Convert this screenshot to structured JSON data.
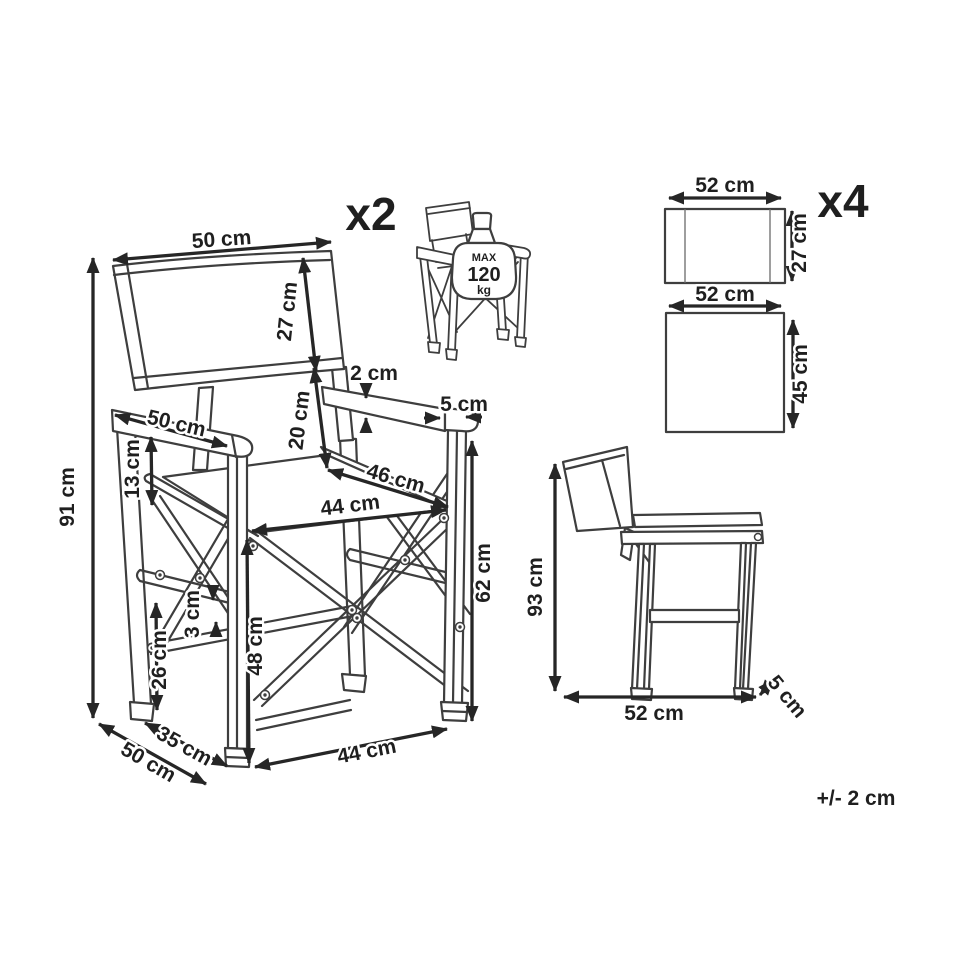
{
  "front_view": {
    "quantity": "x2",
    "back_width": "50 cm",
    "back_height": "27 cm",
    "armrest_thickness": "2 cm",
    "armrest_end_width": "5 cm",
    "back_to_seat_gap": "20 cm",
    "armrest_length": "50 cm",
    "seat_width": "46 cm",
    "seat_depth": "44 cm",
    "armrest_above_seat": "13 cm",
    "overall_height": "91 cm",
    "armrest_height": "62 cm",
    "seat_height": "48 cm",
    "rail_gap": "3 cm",
    "stretcher_height": "26 cm",
    "leg_spread_depth": "35 cm",
    "overall_depth": "50 cm",
    "front_leg_span": "44 cm"
  },
  "max_load_badge": {
    "line1": "MAX",
    "line2": "120",
    "line3": "kg"
  },
  "seat_covers": {
    "quantity": "x4",
    "backrest_cover": {
      "width": "52 cm",
      "height": "27 cm"
    },
    "seat_cover": {
      "width": "52 cm",
      "height": "45 cm"
    }
  },
  "side_view": {
    "height": "93 cm",
    "width": "52 cm",
    "thickness": "5 cm"
  },
  "tolerance": "+/- 2 cm",
  "colors": {
    "line": "#3e3e3e",
    "dimension": "#262626",
    "background": "#ffffff"
  }
}
